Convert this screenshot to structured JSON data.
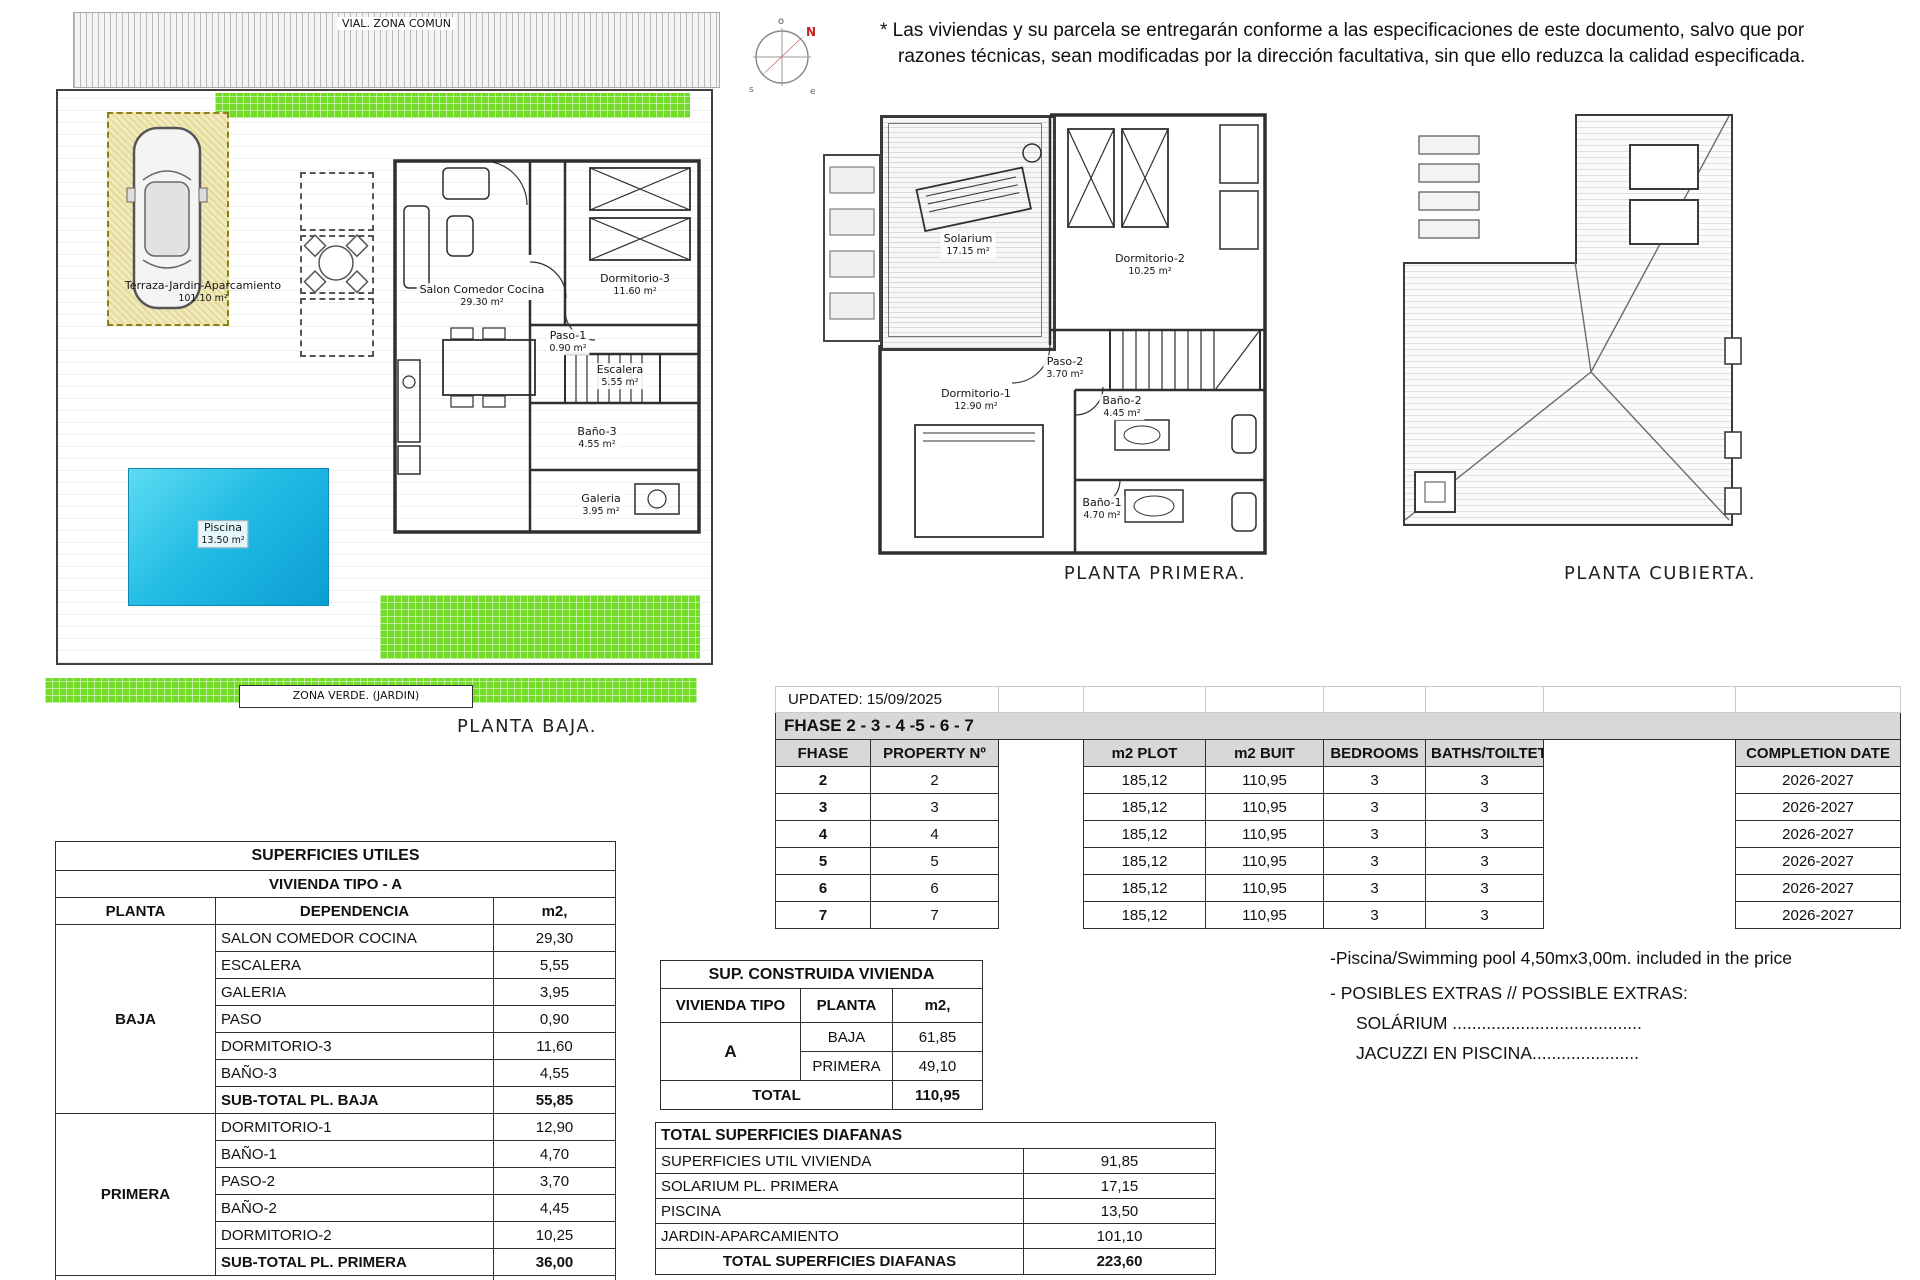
{
  "disclaimer": {
    "line1": "* Las viviendas y su parcela se entregarán conforme a las especificaciones de este documento, salvo que por",
    "line2": "razones técnicas, sean modificadas por la dirección facultativa, sin que ello reduzca la calidad especificada."
  },
  "compass": {
    "points": [
      "o",
      "N",
      "s",
      "e"
    ]
  },
  "plan_baja": {
    "vial": "VIAL. ZONA COMUN",
    "terraza_name": "Terraza-Jardin-Aparcamiento",
    "terraza_area": "101.10 m²",
    "piscina_name": "Piscina",
    "piscina_area": "13.50 m²",
    "salon_name": "Salon Comedor Cocina",
    "salon_area": "29.30 m²",
    "dorm3_name": "Dormitorio-3",
    "dorm3_area": "11.60 m²",
    "paso1_name": "Paso-1",
    "paso1_area": "0.90 m²",
    "escalera_name": "Escalera",
    "escalera_area": "5.55 m²",
    "bano3_name": "Baño-3",
    "bano3_area": "4.55 m²",
    "galeria_name": "Galeria",
    "galeria_area": "3.95 m²",
    "zona_verde": "ZONA VERDE. (JARDIN)",
    "caption": "PLANTA BAJA."
  },
  "plan_primera": {
    "solarium_name": "Solarium",
    "solarium_area": "17.15 m²",
    "dorm2_name": "Dormitorio-2",
    "dorm2_area": "10.25 m²",
    "dorm1_name": "Dormitorio-1",
    "dorm1_area": "12.90 m²",
    "paso2_name": "Paso-2",
    "paso2_area": "3.70 m²",
    "bano2_name": "Baño-2",
    "bano2_area": "4.45 m²",
    "bano1_name": "Baño-1",
    "bano1_area": "4.70 m²",
    "caption": "PLANTA PRIMERA."
  },
  "plan_cubierta": {
    "caption": "PLANTA CUBIERTA."
  },
  "update_notice": "UPDATED: 15/09/2025",
  "phase_table": {
    "band_title": "FHASE  2 - 3 - 4 -5 - 6 - 7",
    "headers": [
      "FHASE",
      "PROPERTY Nº",
      "",
      "m2 PLOT",
      "m2 BUIT",
      "BEDROOMS",
      "BATHS/TOILTET",
      "",
      "COMPLETION DATE"
    ],
    "rows": [
      [
        "2",
        "2",
        "",
        "185,12",
        "110,95",
        "3",
        "3",
        "",
        "2026-2027"
      ],
      [
        "3",
        "3",
        "",
        "185,12",
        "110,95",
        "3",
        "3",
        "",
        "2026-2027"
      ],
      [
        "4",
        "4",
        "",
        "185,12",
        "110,95",
        "3",
        "3",
        "",
        "2026-2027"
      ],
      [
        "5",
        "5",
        "",
        "185,12",
        "110,95",
        "3",
        "3",
        "",
        "2026-2027"
      ],
      [
        "6",
        "6",
        "",
        "185,12",
        "110,95",
        "3",
        "3",
        "",
        "2026-2027"
      ],
      [
        "7",
        "7",
        "",
        "185,12",
        "110,95",
        "3",
        "3",
        "",
        "2026-2027"
      ]
    ]
  },
  "superficies_utiles": {
    "title": "SUPERFICIES UTILES",
    "subtitle": "VIVIENDA TIPO - A",
    "headers": [
      "PLANTA",
      "DEPENDENCIA",
      "m2,"
    ],
    "groups": [
      {
        "planta": "BAJA",
        "rows": [
          [
            "SALON COMEDOR COCINA",
            "29,30"
          ],
          [
            "ESCALERA",
            "5,55"
          ],
          [
            "GALERIA",
            "3,95"
          ],
          [
            "PASO",
            "0,90"
          ],
          [
            "DORMITORIO-3",
            "11,60"
          ],
          [
            "BAÑO-3",
            "4,55"
          ]
        ],
        "subtotal_label": "SUB-TOTAL PL. BAJA",
        "subtotal": "55,85"
      },
      {
        "planta": "PRIMERA",
        "rows": [
          [
            "DORMITORIO-1",
            "12,90"
          ],
          [
            "BAÑO-1",
            "4,70"
          ],
          [
            "PASO-2",
            "3,70"
          ],
          [
            "BAÑO-2",
            "4,45"
          ],
          [
            "DORMITORIO-2",
            "10,25"
          ]
        ],
        "subtotal_label": "SUB-TOTAL PL. PRIMERA",
        "subtotal": "36,00"
      }
    ],
    "total_label": "TOTAL",
    "total": "91,85"
  },
  "sup_construida": {
    "title": "SUP. CONSTRUIDA VIVIENDA",
    "headers": [
      "VIVIENDA TIPO",
      "PLANTA",
      "m2,"
    ],
    "tipo": "A",
    "rows": [
      [
        "BAJA",
        "61,85"
      ],
      [
        "PRIMERA",
        "49,10"
      ]
    ],
    "total_label": "TOTAL",
    "total": "110,95"
  },
  "diafanas": {
    "title": "TOTAL SUPERFICIES DIAFANAS",
    "rows": [
      [
        "SUPERFICIES UTIL VIVIENDA",
        "91,85"
      ],
      [
        "SOLARIUM PL. PRIMERA",
        "17,15"
      ],
      [
        "PISCINA",
        "13,50"
      ],
      [
        "JARDIN-APARCAMIENTO",
        "101,10"
      ]
    ],
    "total_label": "TOTAL SUPERFICIES DIAFANAS",
    "total": "223,60"
  },
  "notes": {
    "pool_note": "-Piscina/Swimming pool 4,50mx3,00m. included in the price",
    "extras_title": "- POSIBLES EXTRAS // POSSIBLE EXTRAS:",
    "extras": [
      "SOLÁRIUM .......................................",
      "JACUZZI EN PISCINA......................"
    ]
  }
}
